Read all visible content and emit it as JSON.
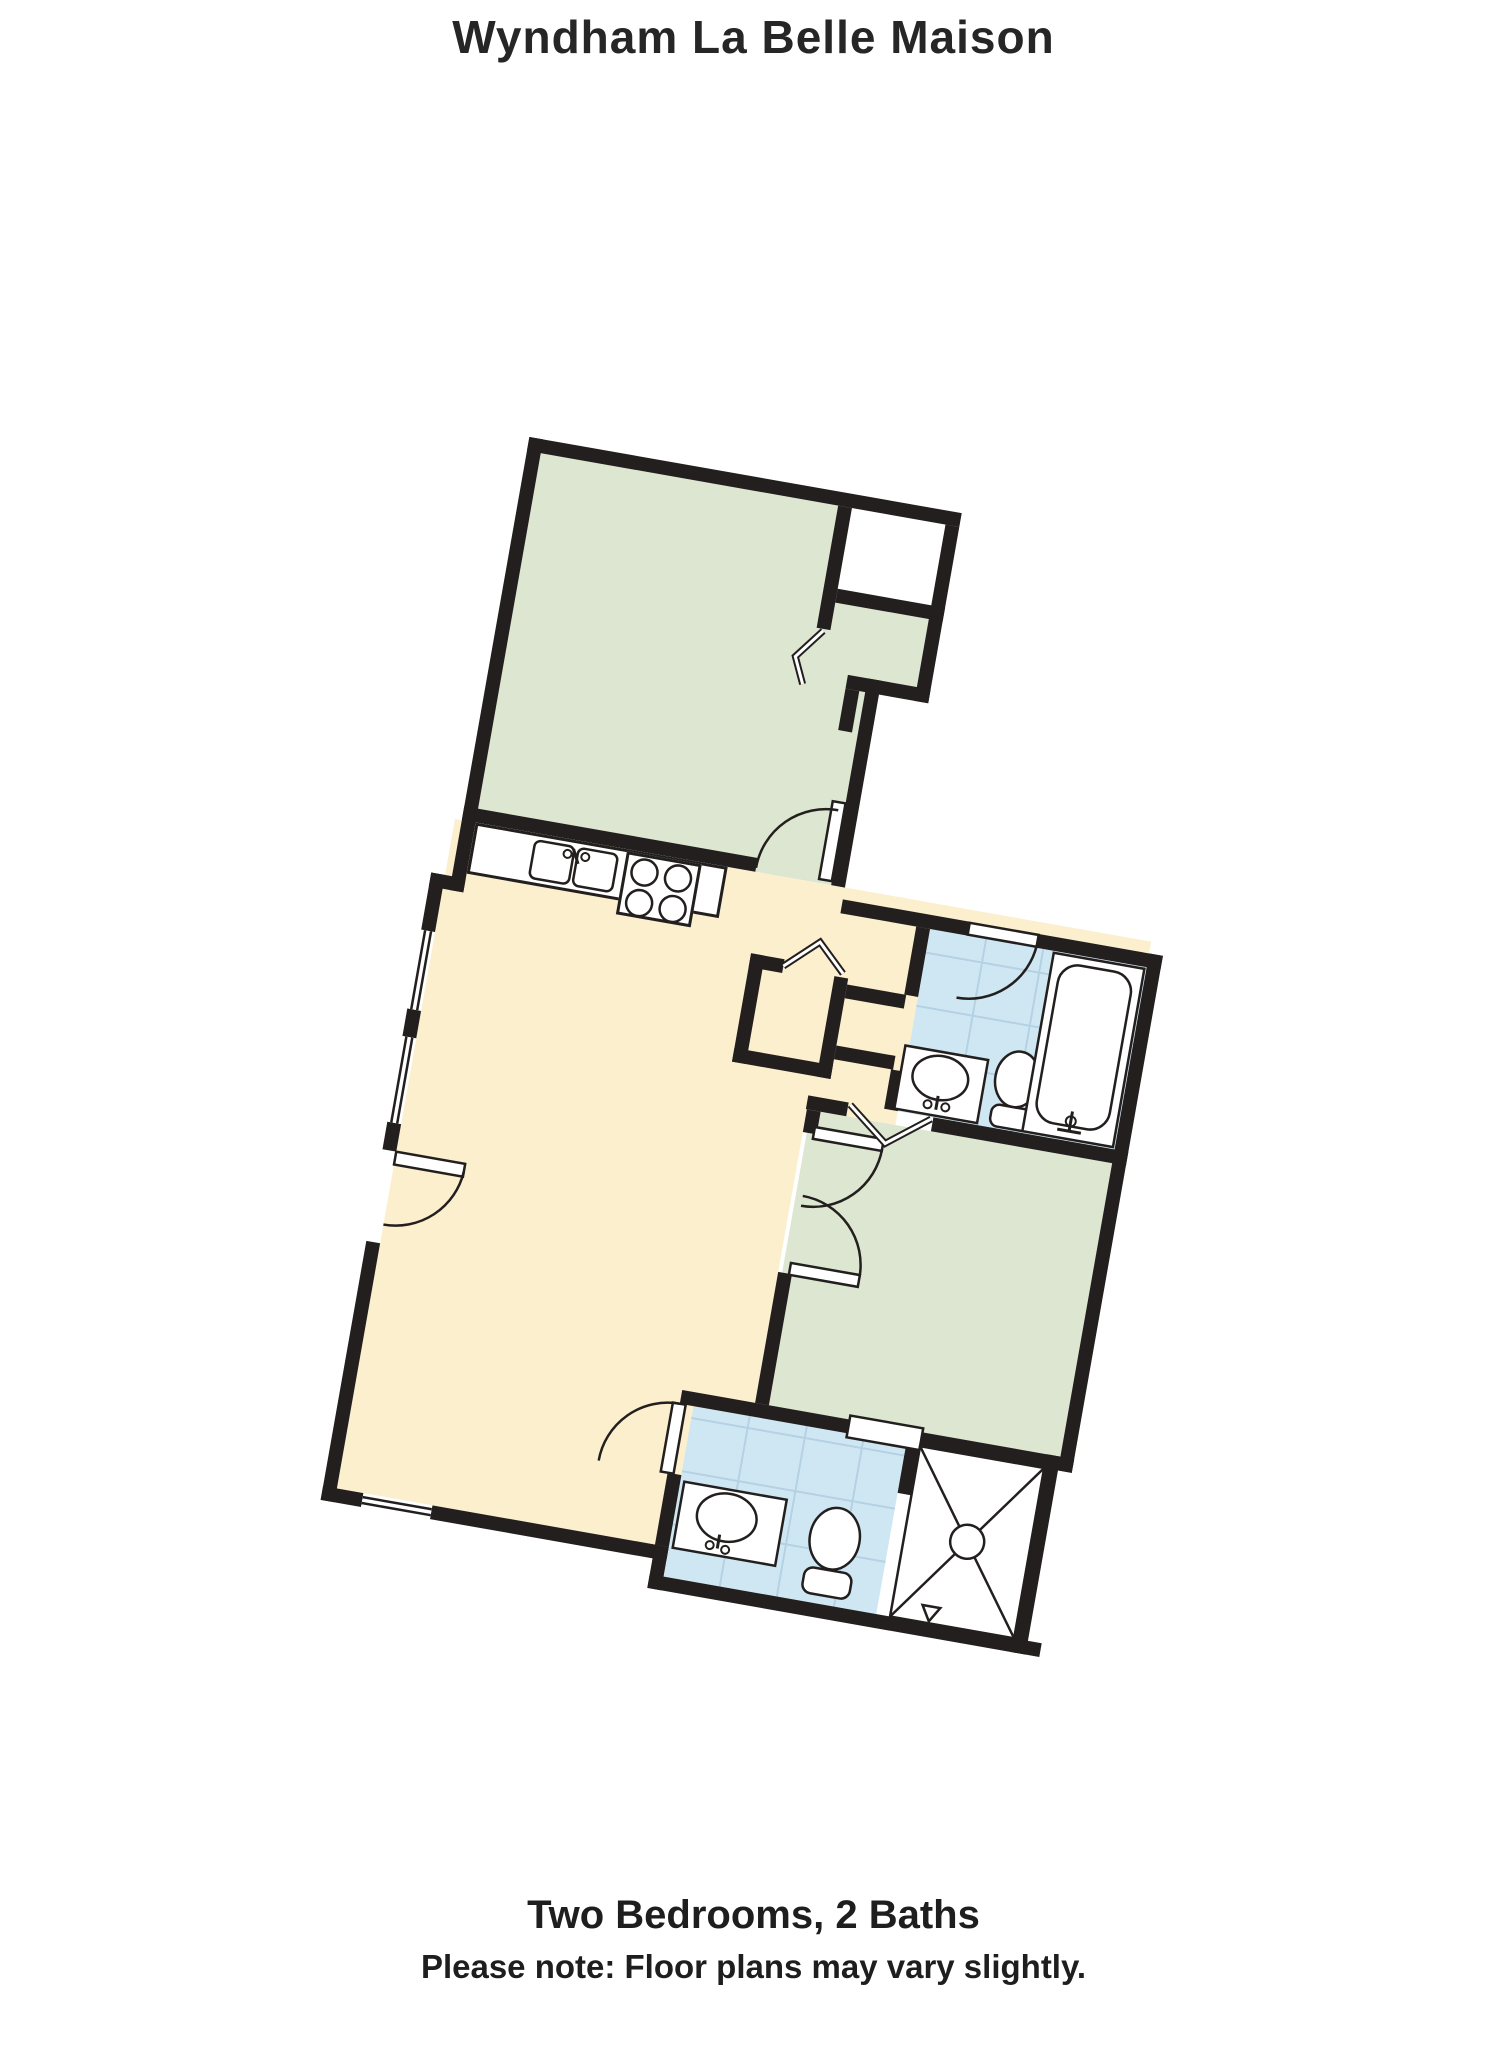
{
  "title": "Wyndham La Belle Maison",
  "footer": {
    "line1": "Two Bedrooms, 2 Baths",
    "line2": "Please note: Floor plans may vary slightly."
  },
  "colors": {
    "wall": "#221f1e",
    "bedroom_floor": "#dde6d0",
    "bathroom_floor": "#cfe7f3",
    "living_floor": "#fcefcd",
    "tile_line": "#b4d2e4",
    "fixture_fill": "#ffffff"
  },
  "rooms": [
    {
      "name": "bedroom-1",
      "type": "bedroom"
    },
    {
      "name": "bedroom-1-closet",
      "type": "closet"
    },
    {
      "name": "kitchen-living-room",
      "type": "living"
    },
    {
      "name": "hall",
      "type": "hall"
    },
    {
      "name": "bathroom-1",
      "type": "bathroom"
    },
    {
      "name": "bedroom-2",
      "type": "bedroom"
    },
    {
      "name": "bathroom-2",
      "type": "bathroom"
    }
  ],
  "fixtures": [
    "kitchen-sink",
    "stove",
    "bathtub",
    "toilet",
    "vanity-sink",
    "shower",
    "pocket-door"
  ]
}
